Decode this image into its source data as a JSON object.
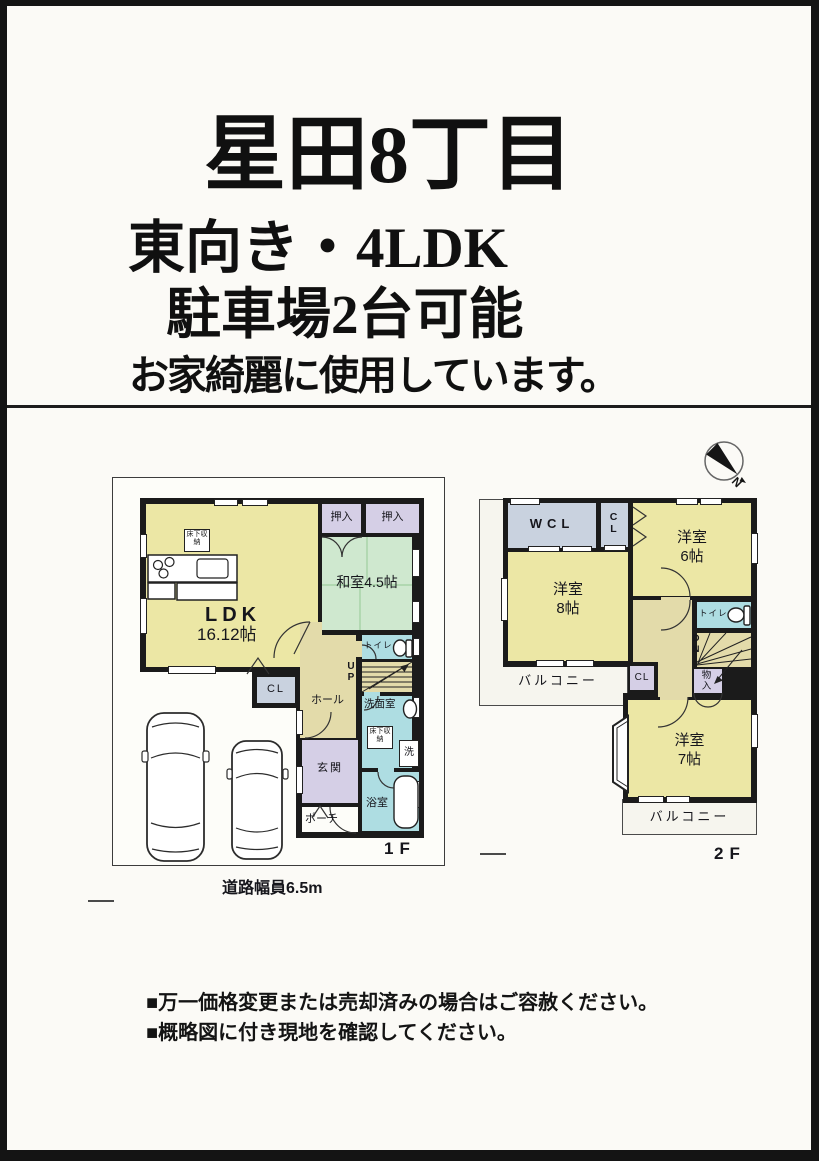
{
  "title": {
    "line1": "星田8丁目",
    "line2": "東向き・4LDK",
    "line3": "駐車場2台可能",
    "line4": "お家綺麗に使用しています。"
  },
  "floor1": {
    "label": "1F",
    "ldk": "LDK",
    "ldk_size": "16.12帖",
    "washitsu": "和室4.5帖",
    "oshiire_left": "押入",
    "oshiire_right": "押入",
    "toilet": "トイレ",
    "stairs_up": "UP",
    "closet": "CL",
    "hall": "ホール",
    "washroom": "洗面室",
    "underfloor_storage_ldk": "床下収納",
    "underfloor_storage_washroom": "床下収納",
    "washer": "洗",
    "entrance": "玄関",
    "bathroom": "浴室",
    "porch": "ポーチ",
    "road_note": "道路幅員6.5m"
  },
  "floor2": {
    "label": "2F",
    "wcl": "WCL",
    "closet_top": "CL",
    "room6": "洋室",
    "room6_size": "6帖",
    "room8": "洋室",
    "room8_size": "8帖",
    "room7": "洋室",
    "room7_size": "7帖",
    "toilet": "トイレ",
    "stairs_down": "DN",
    "storage": "物入",
    "closet_bottom": "CL",
    "balcony_left": "バルコニー",
    "balcony_bottom": "バルコニー"
  },
  "notes": [
    "■万一価格変更または売却済みの場合はご容赦ください。",
    "■概略図に付き現地を確認してください。"
  ],
  "compass": {
    "north_label": "N"
  },
  "colors": {
    "room_yellow": "#ece7a5",
    "tatami_green": "#cfe8cf",
    "wet_blue": "#aedde2",
    "closet_lavender": "#d5cfe6",
    "closet_gray_blue": "#c9d2df",
    "hall_beige": "#e3dbaa",
    "wall_black": "#1b1b1b"
  }
}
